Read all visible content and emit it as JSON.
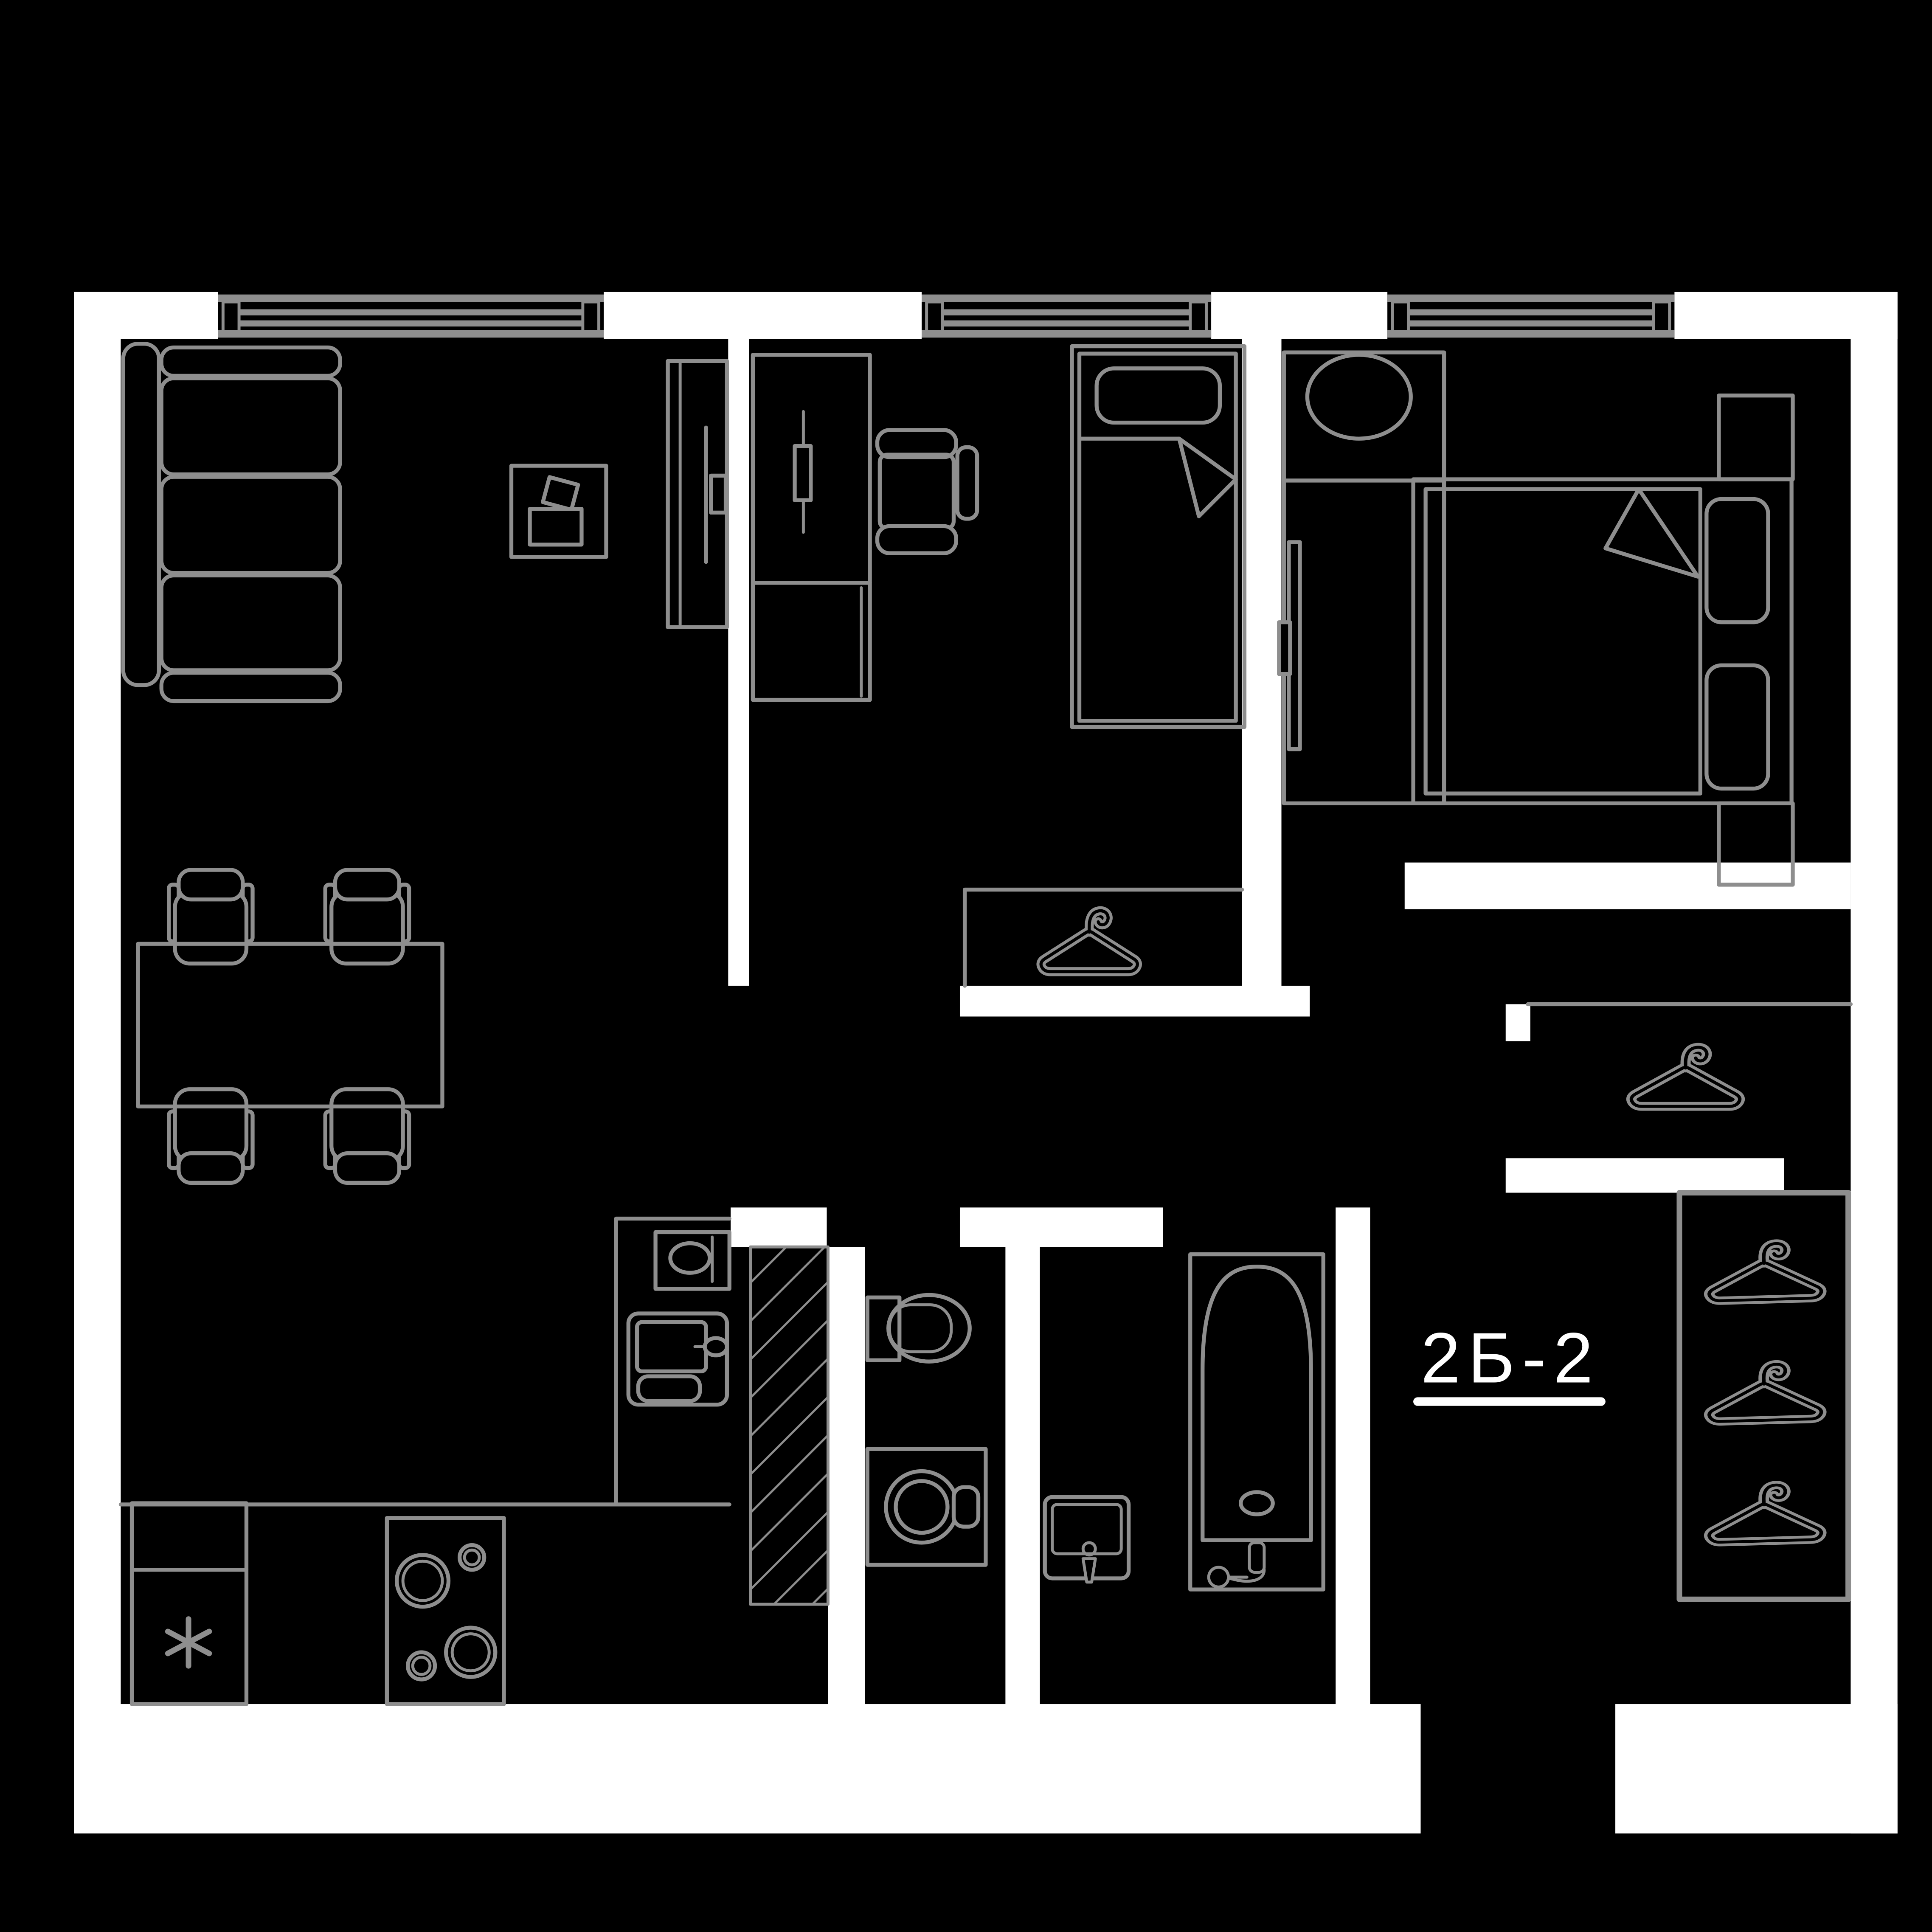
{
  "unit": {
    "label": "2Б-2"
  },
  "colors": {
    "background": "#000000",
    "wall": "#ffffff",
    "line": "#8e8e8e",
    "text": "#ffffff"
  },
  "icons": {
    "bedroom1_closet": "hanger-icon",
    "hall_closet": "hanger-icon",
    "hall_wardrobe": [
      "hanger-icon",
      "hanger-icon",
      "hanger-icon"
    ],
    "fridge": "freezer-star-icon"
  }
}
